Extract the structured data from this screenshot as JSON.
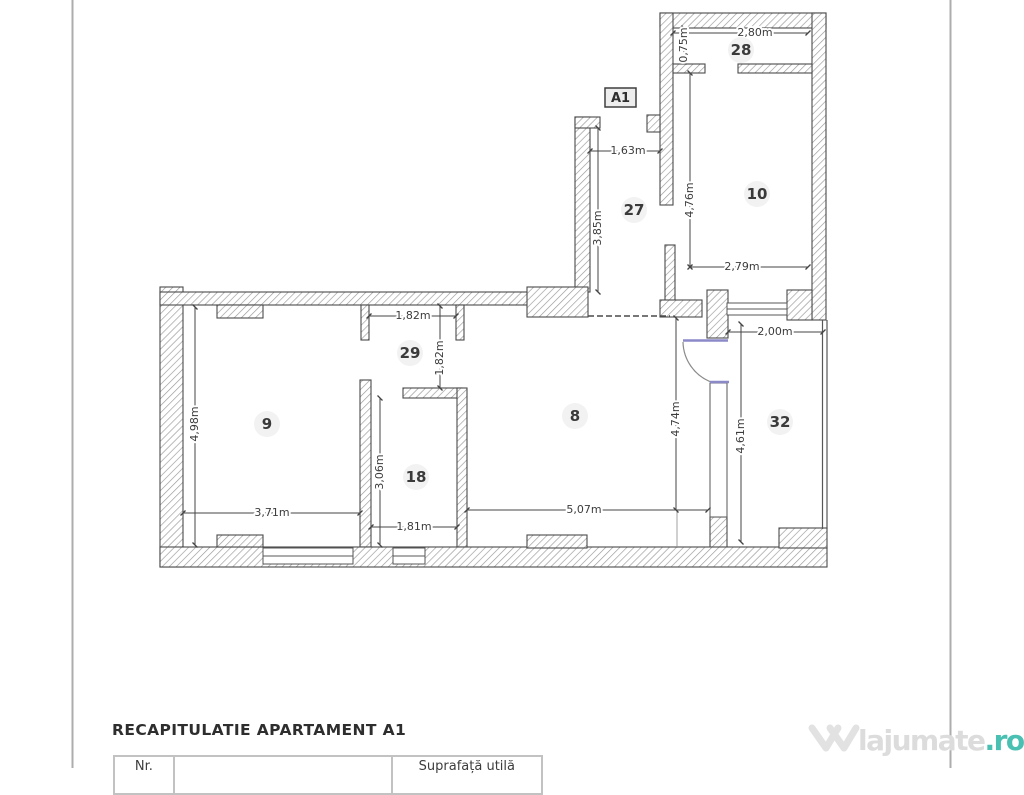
{
  "plan": {
    "unit_label": "A1",
    "rooms": {
      "r28": "28",
      "r10": "10",
      "r27": "27",
      "r29": "29",
      "r9": "9",
      "r18": "18",
      "r8": "8",
      "r32": "32"
    },
    "dims": {
      "r28_w": "2,80m",
      "r28_h": "0,75m",
      "r10_h": "4,76m",
      "r10_w": "2,79m",
      "r27_w": "1,63m",
      "r27_h": "3,85m",
      "r29_w": "1,82m",
      "r29_h": "1,82m",
      "r9_h": "4,98m",
      "r9_w": "3,71m",
      "r18_h": "3,06m",
      "r18_w": "1,81m",
      "r8_w": "5,07m",
      "r8_h": "4,74m",
      "r32_w": "2,00m",
      "r32_h": "4,61m"
    },
    "door_color": "#8c89c9"
  },
  "recap": {
    "heading": "RECAPITULATIE APARTAMENT A1",
    "table": {
      "headers": [
        "Nr.",
        "",
        "Suprafață utilă"
      ]
    }
  },
  "watermark": {
    "name": "lajumate",
    "tld": ".ro",
    "tld_color": "#4ac0b2"
  }
}
